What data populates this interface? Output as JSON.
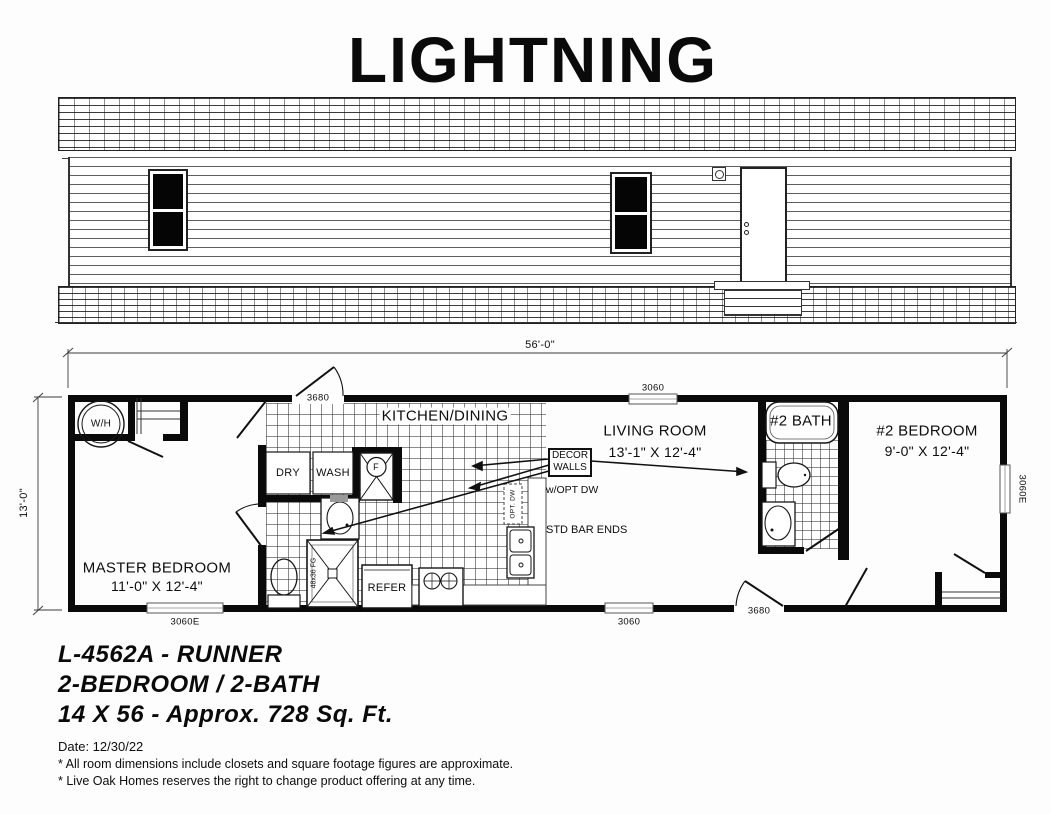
{
  "title": "LIGHTNING",
  "plan": {
    "width_dim": "56'-0\"",
    "depth_dim": "13'-0\"",
    "master_bedroom_name": "MASTER BEDROOM",
    "master_bedroom_size": "11'-0\" X 12'-4\"",
    "kitchen_name": "KITCHEN/DINING",
    "living_name": "LIVING ROOM",
    "living_size": "13'-1\" X 12'-4\"",
    "bath2_name": "#2 BATH",
    "bedroom2_name": "#2 BEDROOM",
    "bedroom2_size": "9'-0\" X 12'-4\"",
    "water_heater": "W/H",
    "dryer": "DRY",
    "washer": "WASH",
    "furnace": "F",
    "refrigerator": "REFER",
    "shower_size": "48x36 FG",
    "decor_walls": "DECOR WALLS",
    "opt_dw_note": "w/OPT DW",
    "opt_dw_box": "OPT. DW",
    "std_bar_ends": "STD BAR ENDS",
    "front_door": "3680",
    "rear_door": "3680",
    "window_top": "3060",
    "window_bottom": "3060",
    "window_master": "3060E",
    "window_bedroom2": "3060E"
  },
  "footer": {
    "model": "L-4562A - RUNNER",
    "config": "2-BEDROOM / 2-BATH",
    "size": "14 X 56 - Approx. 728 Sq. Ft.",
    "date": "Date: 12/30/22",
    "note1": "* All room dimensions include closets and square footage figures are approximate.",
    "note2": "* Live Oak Homes reserves the right to change product offering at any time."
  }
}
